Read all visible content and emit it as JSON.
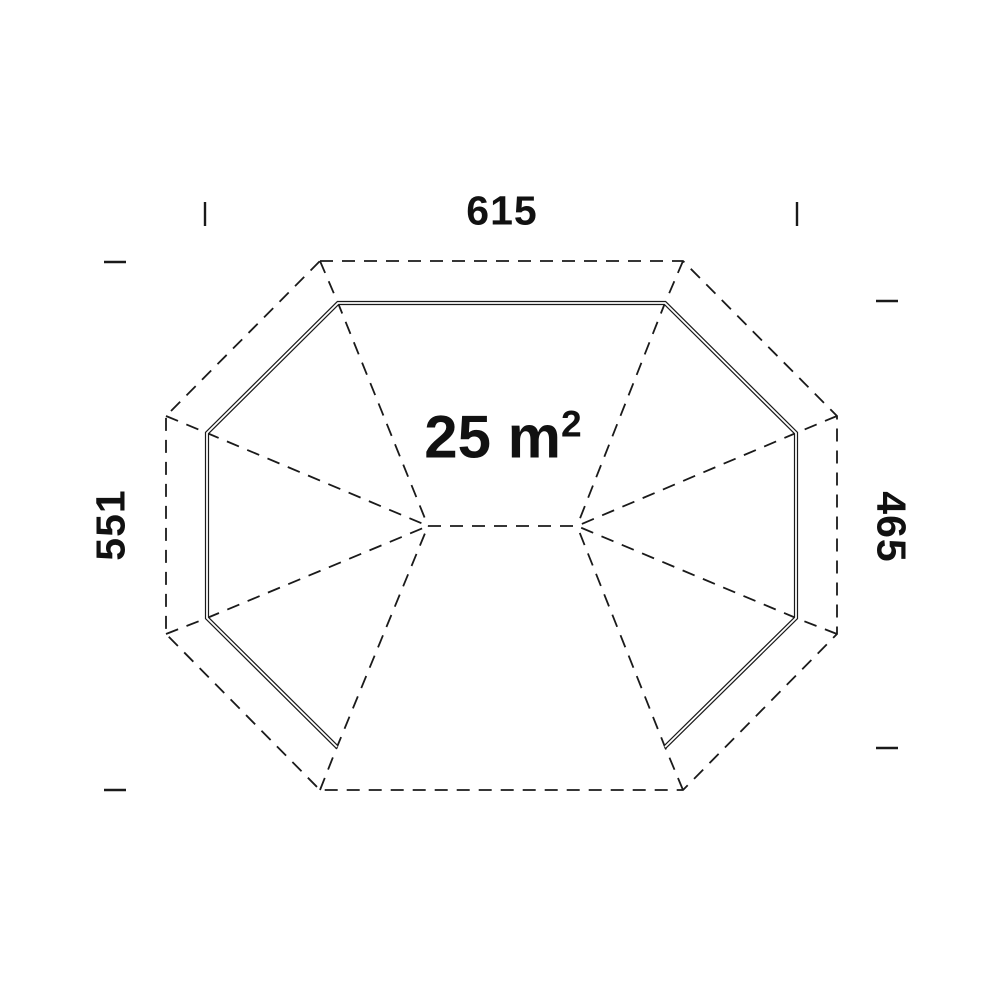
{
  "area": {
    "text": "25 m",
    "exponent": "2"
  },
  "dimensions": {
    "top": {
      "value": "615"
    },
    "left": {
      "value": "551"
    },
    "right": {
      "value": "465"
    }
  },
  "colors": {
    "line": "#1a1a1a",
    "text": "#111111",
    "background": "#ffffff",
    "wall_gap": "#ffffff"
  },
  "geometry": {
    "canvas": {
      "width": 1000,
      "height": 1000
    },
    "outer_octagon": [
      [
        320,
        261
      ],
      [
        683,
        261
      ],
      [
        837,
        416
      ],
      [
        837,
        634
      ],
      [
        683,
        790
      ],
      [
        320,
        790
      ],
      [
        166,
        634
      ],
      [
        166,
        416
      ]
    ],
    "wall_polyline": [
      [
        665,
        747
      ],
      [
        796,
        618
      ],
      [
        796,
        433
      ],
      [
        665,
        303
      ],
      [
        338,
        303
      ],
      [
        207,
        433
      ],
      [
        207,
        618
      ],
      [
        337,
        747
      ]
    ],
    "hubs": [
      [
        428,
        526
      ],
      [
        577,
        526
      ]
    ],
    "ridge_line": [
      [
        428,
        526
      ],
      [
        577,
        526
      ]
    ],
    "hip_lines": [
      [
        [
          320,
          261
        ],
        [
          338,
          303
        ],
        [
          428,
          526
        ]
      ],
      [
        [
          166,
          416
        ],
        [
          207,
          433
        ],
        [
          428,
          526
        ]
      ],
      [
        [
          166,
          634
        ],
        [
          207,
          618
        ],
        [
          428,
          526
        ]
      ],
      [
        [
          320,
          790
        ],
        [
          337,
          747
        ],
        [
          428,
          526
        ]
      ],
      [
        [
          683,
          261
        ],
        [
          665,
          303
        ],
        [
          577,
          526
        ]
      ],
      [
        [
          837,
          416
        ],
        [
          796,
          433
        ],
        [
          577,
          526
        ]
      ],
      [
        [
          837,
          634
        ],
        [
          796,
          618
        ],
        [
          577,
          526
        ]
      ],
      [
        [
          683,
          790
        ],
        [
          665,
          747
        ],
        [
          577,
          526
        ]
      ]
    ],
    "ticks": [
      {
        "name": "tick-top-left",
        "x1": 205,
        "y1": 202,
        "x2": 205,
        "y2": 226
      },
      {
        "name": "tick-top-right",
        "x1": 797,
        "y1": 202,
        "x2": 797,
        "y2": 226
      },
      {
        "name": "tick-left-upper",
        "x1": 104,
        "y1": 262,
        "x2": 126,
        "y2": 262
      },
      {
        "name": "tick-left-lower",
        "x1": 104,
        "y1": 790,
        "x2": 126,
        "y2": 790
      },
      {
        "name": "tick-right-upper",
        "x1": 876,
        "y1": 301,
        "x2": 898,
        "y2": 301
      },
      {
        "name": "tick-right-lower",
        "x1": 876,
        "y1": 748,
        "x2": 898,
        "y2": 748
      }
    ],
    "style": {
      "dash": "13 9",
      "line_width": 1.8,
      "wall_outer_width": 4.2,
      "wall_gap_width": 1.8,
      "tick_width": 2.4
    }
  }
}
